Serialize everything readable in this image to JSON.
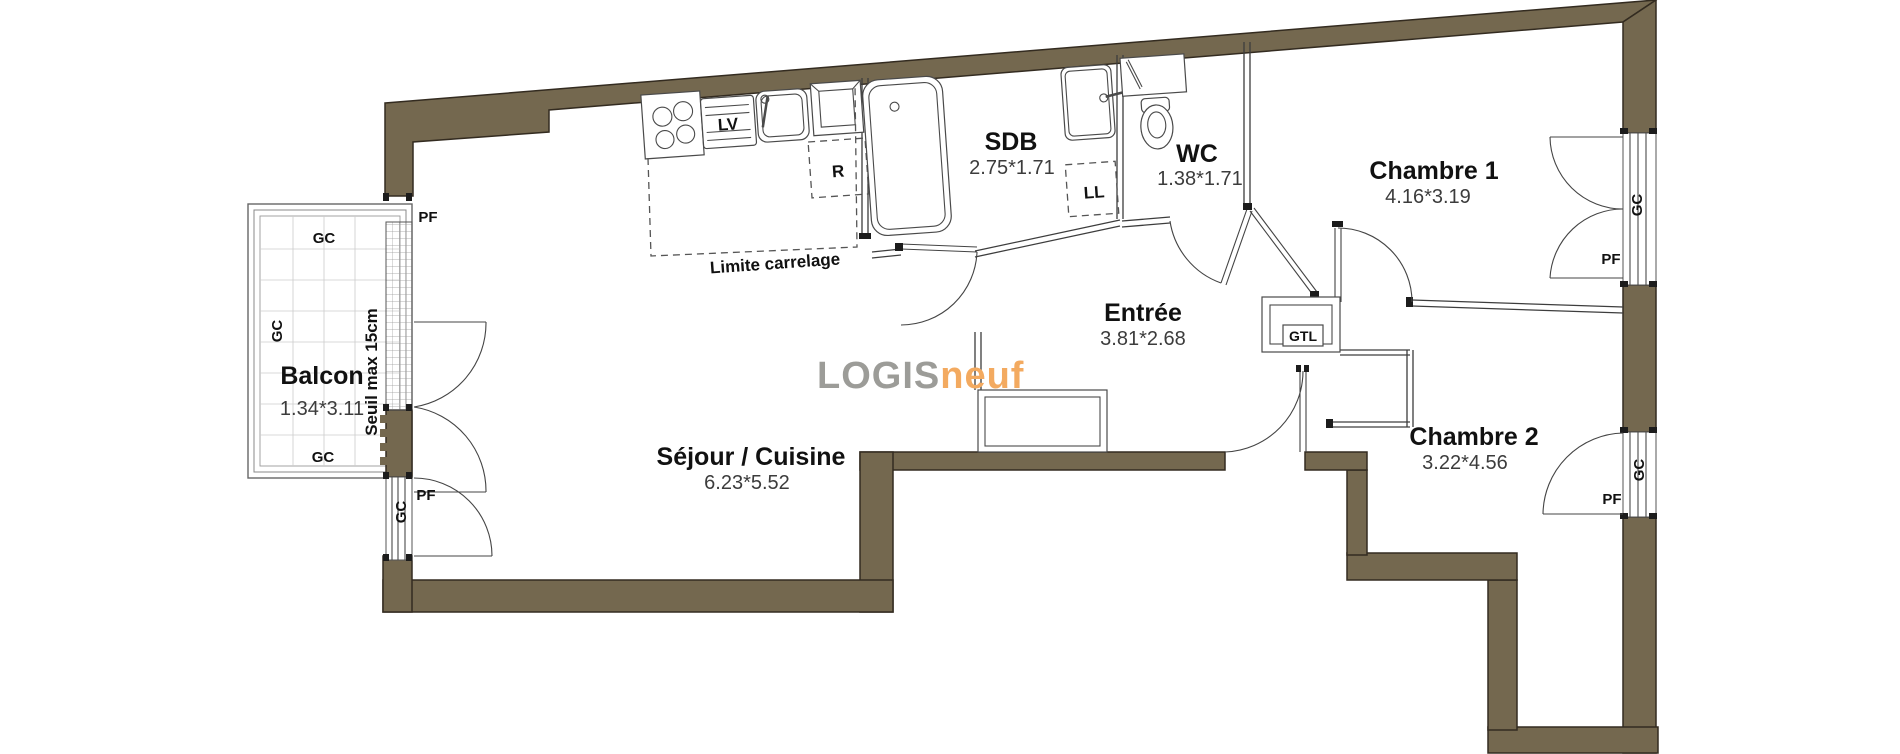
{
  "plan": {
    "rooms": [
      {
        "id": "balcon",
        "name": "Balcon",
        "dims": "1.34*3.11"
      },
      {
        "id": "sejour",
        "name": "Séjour / Cuisine",
        "dims": "6.23*5.52"
      },
      {
        "id": "sdb",
        "name": "SDB",
        "dims": "2.75*1.71"
      },
      {
        "id": "wc",
        "name": "WC",
        "dims": "1.38*1.71"
      },
      {
        "id": "entree",
        "name": "Entrée",
        "dims": "3.81*2.68"
      },
      {
        "id": "chambre1",
        "name": "Chambre 1",
        "dims": "4.16*3.19"
      },
      {
        "id": "chambre2",
        "name": "Chambre 2",
        "dims": "3.22*4.56"
      }
    ],
    "labels": {
      "gc": "GC",
      "pf": "PF",
      "dishwasher": "LV",
      "fridge": "R",
      "washer": "LL",
      "gtl": "GTL",
      "limite_carrelage": "Limite carrelage",
      "seuil": "Seuil max 15cm"
    },
    "logo": {
      "part1": "LOGIS",
      "part2": "neuf"
    },
    "colors": {
      "wall": "#74684f",
      "wall_outline": "#332b20",
      "logo_gray": "#9c9c98",
      "logo_orange": "#f3aa60"
    }
  }
}
